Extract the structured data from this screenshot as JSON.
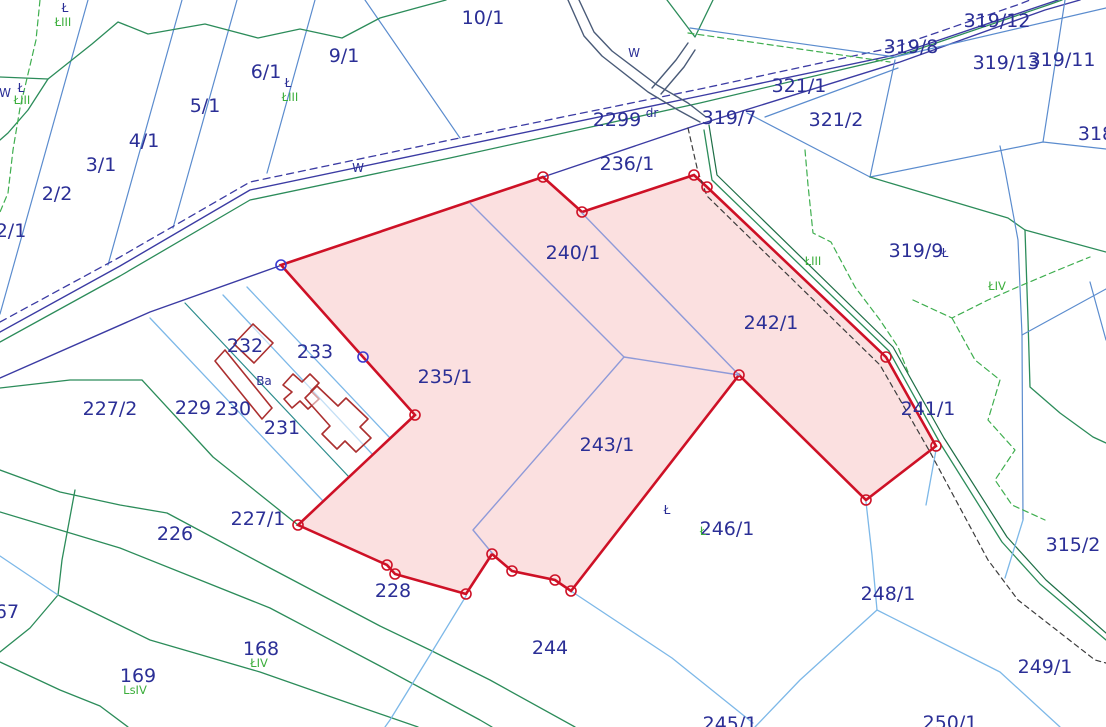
{
  "map": {
    "colors": {
      "selection_red": "#ce1126",
      "selection_pink_fill": "rgba(230,70,70,0.17)",
      "parcel_text_navy": "#2b2f96",
      "landuse_text_green": "#3cae3c",
      "boundary_blue": "#5b8cce",
      "boundary_green": "#2c8c5a",
      "building_maroon": "#ab2f2f"
    },
    "labels": [
      {
        "text": "10/1",
        "x": 483,
        "y": 24,
        "cls": "navy-lg"
      },
      {
        "text": "9/1",
        "x": 344,
        "y": 62,
        "cls": "navy-lg"
      },
      {
        "text": "6/1",
        "x": 266,
        "y": 78,
        "cls": "navy-lg"
      },
      {
        "text": "5/1",
        "x": 205,
        "y": 112,
        "cls": "navy-lg"
      },
      {
        "text": "4/1",
        "x": 144,
        "y": 147,
        "cls": "navy-lg"
      },
      {
        "text": "3/1",
        "x": 101,
        "y": 171,
        "cls": "navy-lg"
      },
      {
        "text": "2/2",
        "x": 57,
        "y": 200,
        "cls": "navy-lg"
      },
      {
        "text": "2/1",
        "x": 11,
        "y": 237,
        "cls": "navy-lg"
      },
      {
        "text": "2299",
        "x": 617,
        "y": 126,
        "cls": "navy-lg"
      },
      {
        "text": "236/1",
        "x": 627,
        "y": 170,
        "cls": "navy-lg"
      },
      {
        "text": "319/7",
        "x": 729,
        "y": 124,
        "cls": "navy-lg"
      },
      {
        "text": "321/1",
        "x": 799,
        "y": 92,
        "cls": "navy-lg"
      },
      {
        "text": "321/2",
        "x": 836,
        "y": 126,
        "cls": "navy-lg"
      },
      {
        "text": "319/8",
        "x": 911,
        "y": 53,
        "cls": "navy-lg"
      },
      {
        "text": "319/12",
        "x": 997,
        "y": 27,
        "cls": "navy-lg"
      },
      {
        "text": "319/13",
        "x": 1006,
        "y": 69,
        "cls": "navy-lg"
      },
      {
        "text": "319/11",
        "x": 1062,
        "y": 66,
        "cls": "navy-lg"
      },
      {
        "text": "318",
        "x": 1096,
        "y": 140,
        "cls": "navy-lg"
      },
      {
        "text": "319/9",
        "x": 916,
        "y": 257,
        "cls": "navy-lg"
      },
      {
        "text": "240/1",
        "x": 573,
        "y": 259,
        "cls": "navy-lg"
      },
      {
        "text": "242/1",
        "x": 771,
        "y": 329,
        "cls": "navy-lg"
      },
      {
        "text": "235/1",
        "x": 445,
        "y": 383,
        "cls": "navy-lg"
      },
      {
        "text": "241/1",
        "x": 928,
        "y": 415,
        "cls": "navy-lg"
      },
      {
        "text": "243/1",
        "x": 607,
        "y": 451,
        "cls": "navy-lg"
      },
      {
        "text": "233",
        "x": 315,
        "y": 358,
        "cls": "navy-lg"
      },
      {
        "text": "232",
        "x": 245,
        "y": 352,
        "cls": "navy-lg"
      },
      {
        "text": "229",
        "x": 193,
        "y": 414,
        "cls": "navy-lg"
      },
      {
        "text": "230",
        "x": 233,
        "y": 415,
        "cls": "navy-lg"
      },
      {
        "text": "231",
        "x": 282,
        "y": 434,
        "cls": "navy-lg"
      },
      {
        "text": "227/2",
        "x": 110,
        "y": 415,
        "cls": "navy-lg"
      },
      {
        "text": "227/1",
        "x": 258,
        "y": 525,
        "cls": "navy-lg"
      },
      {
        "text": "226",
        "x": 175,
        "y": 540,
        "cls": "navy-lg"
      },
      {
        "text": "228",
        "x": 393,
        "y": 597,
        "cls": "navy-lg"
      },
      {
        "text": "244",
        "x": 550,
        "y": 654,
        "cls": "navy-lg"
      },
      {
        "text": "246/1",
        "x": 727,
        "y": 535,
        "cls": "navy-lg"
      },
      {
        "text": "245/1",
        "x": 730,
        "y": 730,
        "cls": "navy-lg"
      },
      {
        "text": "250/1",
        "x": 950,
        "y": 729,
        "cls": "navy-lg"
      },
      {
        "text": "249/1",
        "x": 1045,
        "y": 673,
        "cls": "navy-lg"
      },
      {
        "text": "248/1",
        "x": 888,
        "y": 600,
        "cls": "navy-lg"
      },
      {
        "text": "315/2",
        "x": 1073,
        "y": 551,
        "cls": "navy-lg"
      },
      {
        "text": "168",
        "x": 261,
        "y": 655,
        "cls": "navy-lg"
      },
      {
        "text": "169",
        "x": 138,
        "y": 682,
        "cls": "navy-lg"
      },
      {
        "text": "67",
        "x": 7,
        "y": 618,
        "cls": "navy-lg"
      },
      {
        "text": "dr",
        "x": 652,
        "y": 117,
        "cls": "navy-sm"
      },
      {
        "text": "W",
        "x": 358,
        "y": 172,
        "cls": "navy-sm"
      },
      {
        "text": "W",
        "x": 634,
        "y": 57,
        "cls": "navy-sm"
      },
      {
        "text": "W",
        "x": 5,
        "y": 97,
        "cls": "navy-sm"
      },
      {
        "text": "Ł",
        "x": 21,
        "y": 92,
        "cls": "navy-sm"
      },
      {
        "text": "Ł",
        "x": 65,
        "y": 12,
        "cls": "navy-sm"
      },
      {
        "text": "Ł",
        "x": 288,
        "y": 87,
        "cls": "navy-sm"
      },
      {
        "text": "Ł",
        "x": 945,
        "y": 257,
        "cls": "navy-sm"
      },
      {
        "text": "Ł",
        "x": 667,
        "y": 514,
        "cls": "navy-sm"
      },
      {
        "text": "Ba",
        "x": 264,
        "y": 385,
        "cls": "navy-sm"
      },
      {
        "text": "ŁIII",
        "x": 63,
        "y": 26,
        "cls": "green-sm"
      },
      {
        "text": "ŁIII",
        "x": 22,
        "y": 104,
        "cls": "green-sm"
      },
      {
        "text": "ŁIII",
        "x": 290,
        "y": 101,
        "cls": "green-sm"
      },
      {
        "text": "ŁIII",
        "x": 813,
        "y": 265,
        "cls": "green-sm"
      },
      {
        "text": "ŁIV",
        "x": 997,
        "y": 290,
        "cls": "green-sm"
      },
      {
        "text": "ŁIV",
        "x": 259,
        "y": 667,
        "cls": "green-sm"
      },
      {
        "text": "LsIV",
        "x": 135,
        "y": 694,
        "cls": "green-sm"
      },
      {
        "text": "Ł",
        "x": 703,
        "y": 535,
        "cls": "green-sm"
      }
    ],
    "selection": {
      "outline": [
        [
          281,
          265
        ],
        [
          543,
          177
        ],
        [
          582,
          212
        ],
        [
          694,
          175
        ],
        [
          707,
          187
        ],
        [
          886,
          357
        ],
        [
          936,
          446
        ],
        [
          866,
          500
        ],
        [
          739,
          375
        ],
        [
          571,
          591
        ],
        [
          555,
          580
        ],
        [
          512,
          571
        ],
        [
          492,
          554
        ],
        [
          466,
          594
        ],
        [
          395,
          574
        ],
        [
          387,
          565
        ],
        [
          298,
          525
        ],
        [
          415,
          415
        ],
        [
          363,
          357
        ]
      ],
      "vertices_red": [
        [
          543,
          177
        ],
        [
          582,
          212
        ],
        [
          694,
          175
        ],
        [
          707,
          187
        ],
        [
          886,
          357
        ],
        [
          936,
          446
        ],
        [
          866,
          500
        ],
        [
          739,
          375
        ],
        [
          571,
          591
        ],
        [
          555,
          580
        ],
        [
          512,
          571
        ],
        [
          492,
          554
        ],
        [
          466,
          594
        ],
        [
          395,
          574
        ],
        [
          387,
          565
        ],
        [
          298,
          525
        ],
        [
          415,
          415
        ]
      ],
      "vertices_blue": [
        [
          281,
          265
        ],
        [
          363,
          357
        ]
      ]
    }
  }
}
